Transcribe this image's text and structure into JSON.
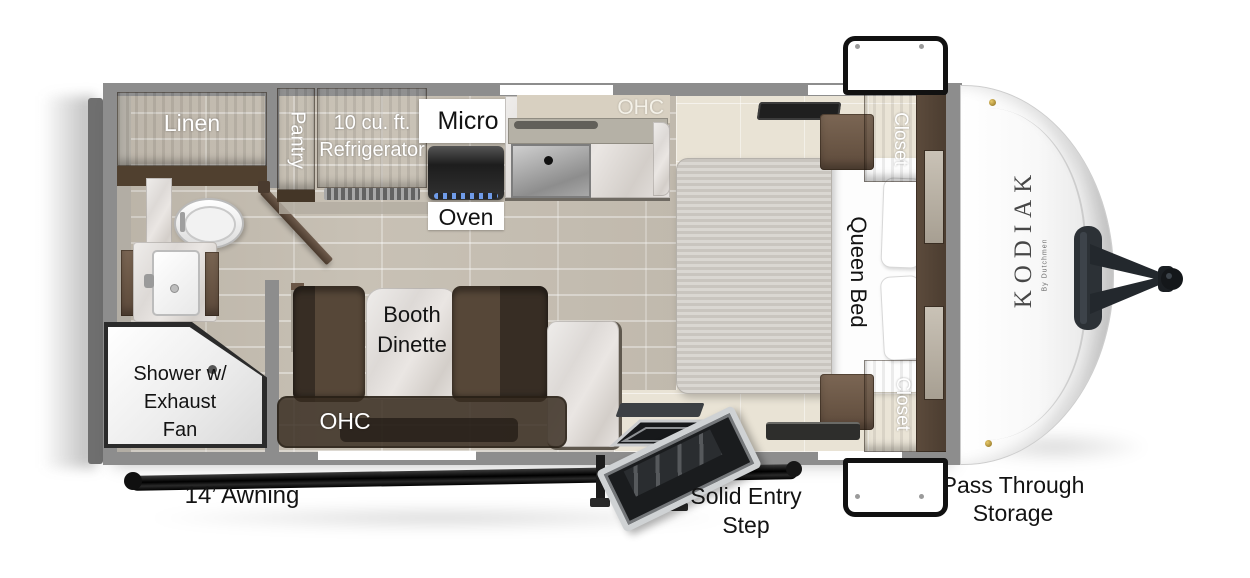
{
  "floorplan": {
    "brand": {
      "name": "KODIAK",
      "byline": "By Dutchmen"
    },
    "bathroom": {
      "linen": "Linen",
      "shower_l1": "Shower w/",
      "shower_l2": "Exhaust",
      "shower_l3": "Fan"
    },
    "kitchen": {
      "pantry": "Pantry",
      "fridge_l1": "10 cu. ft.",
      "fridge_l2": "Refrigerator",
      "micro": "Micro",
      "oven": "Oven",
      "ohc": "OHC"
    },
    "dinette": {
      "l1": "Booth",
      "l2": "Dinette",
      "ohc": "OHC"
    },
    "bedroom": {
      "bed": "Queen Bed",
      "closet_top": "Closet",
      "closet_bottom": "Closet"
    },
    "exterior": {
      "awning": "14’ Awning",
      "entry_l1": "Solid Entry",
      "entry_l2": "Step",
      "storage_l1": "Pass Through",
      "storage_l2": "Storage"
    },
    "colors": {
      "wall": "#8d8d8d",
      "bumper": "#6f6f6f",
      "wood": "#6a5748",
      "floor_wood": "#c8c1b5",
      "floor_tile": "#e9e3d5",
      "marble": "#e4dfdb",
      "awning": "#111111",
      "front_cap": "#ffffff"
    }
  }
}
